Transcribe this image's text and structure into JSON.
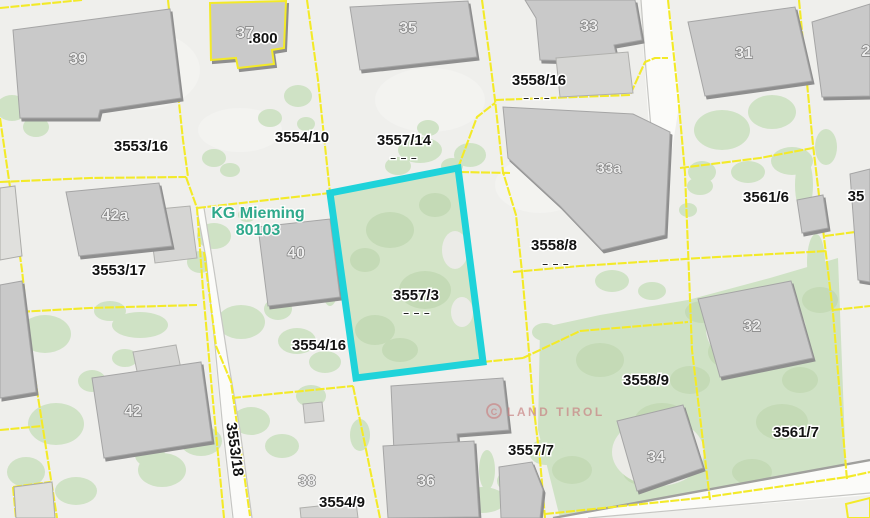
{
  "map": {
    "kg_label": {
      "line1": "KG Mieming",
      "line2": "80103"
    },
    "watermark": {
      "symbol": "C",
      "text": "LAND TIROL"
    },
    "dash_symbol": "– – –",
    "highlight_parcel": "3557/3",
    "colors": {
      "highlight": "#1fd3da",
      "boundary": "#f3ea28",
      "kg_text": "#2fa98c",
      "watermark": "#c98484",
      "vegetation": "#cfe2c5",
      "building": "#c9c9c9"
    },
    "parcel_labels": [
      {
        "text": "3553/16"
      },
      {
        "text": "3554/10"
      },
      {
        "text": "3557/14",
        "dashes": true
      },
      {
        "text": "3558/16",
        "dashes": true
      },
      {
        "text": "3558/8",
        "dashes": true
      },
      {
        "text": "3557/3",
        "dashes": true
      },
      {
        "text": "3553/17"
      },
      {
        "text": "3554/16"
      },
      {
        "text": "3561/6"
      },
      {
        "text": "3558/9"
      },
      {
        "text": "3561/7"
      },
      {
        "text": "3557/7"
      },
      {
        "text": "3554/9"
      },
      {
        "text": "3553/18"
      },
      {
        "text": ".800"
      },
      {
        "text": "35"
      }
    ],
    "building_labels": [
      {
        "text": "39"
      },
      {
        "text": "37"
      },
      {
        "text": "35"
      },
      {
        "text": "33"
      },
      {
        "text": "31"
      },
      {
        "text": "2"
      },
      {
        "text": "42a"
      },
      {
        "text": "40"
      },
      {
        "text": "33a"
      },
      {
        "text": "32"
      },
      {
        "text": "42"
      },
      {
        "text": "36"
      },
      {
        "text": "34"
      },
      {
        "text": "38"
      }
    ]
  }
}
